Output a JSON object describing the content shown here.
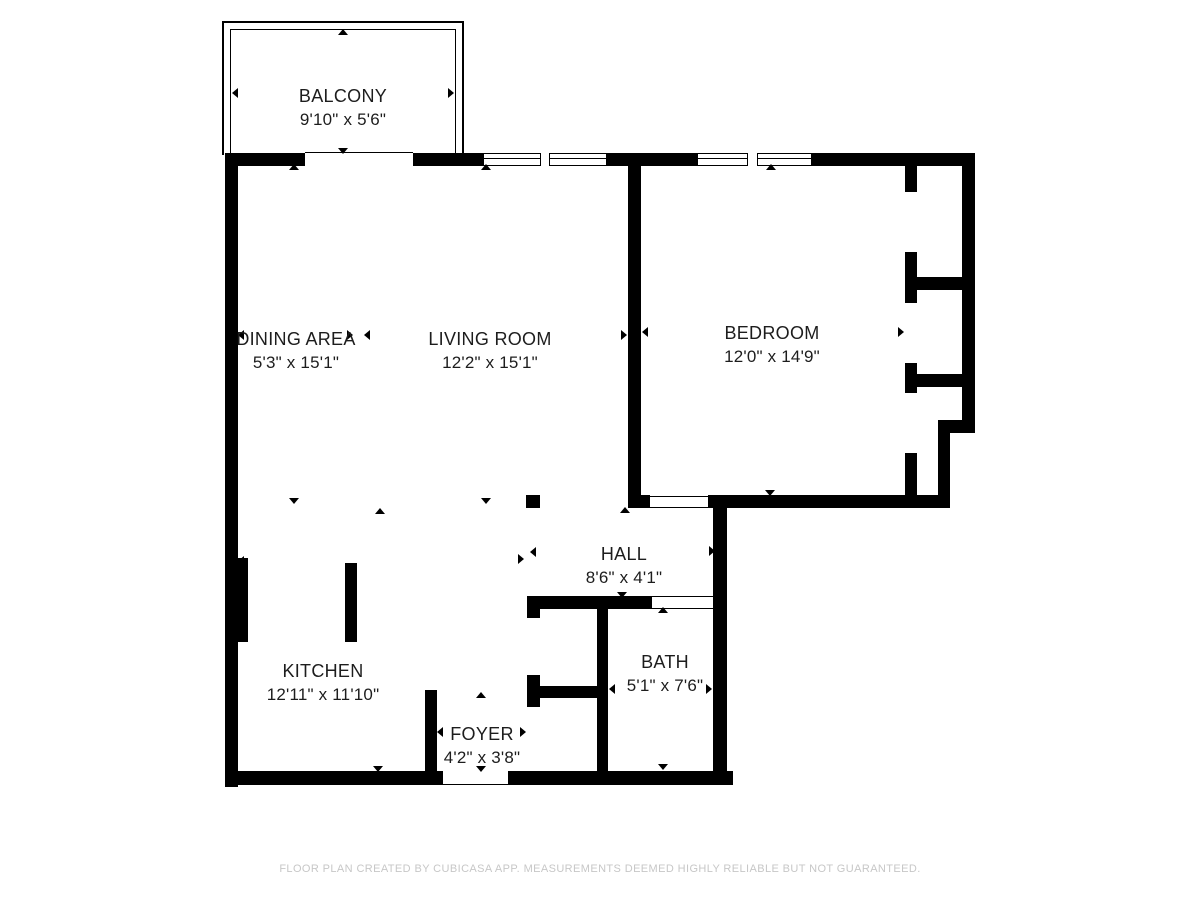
{
  "rooms": {
    "balcony": {
      "name": "BALCONY",
      "dimensions": "9'10\" x 5'6\""
    },
    "dining": {
      "name": "DINING AREA",
      "dimensions": "5'3\" x 15'1\""
    },
    "living": {
      "name": "LIVING ROOM",
      "dimensions": "12'2\" x 15'1\""
    },
    "bedroom": {
      "name": "BEDROOM",
      "dimensions": "12'0\" x 14'9\""
    },
    "hall": {
      "name": "HALL",
      "dimensions": "8'6\" x 4'1\""
    },
    "bath": {
      "name": "BATH",
      "dimensions": "5'1\" x 7'6\""
    },
    "kitchen": {
      "name": "KITCHEN",
      "dimensions": "12'11\" x 11'10\""
    },
    "foyer": {
      "name": "FOYER",
      "dimensions": "4'2\" x 3'8\""
    }
  },
  "footer": {
    "disclaimer": "FLOOR PLAN CREATED BY CUBICASA APP. MEASUREMENTS DEEMED HIGHLY RELIABLE BUT NOT GUARANTEED."
  },
  "colors": {
    "wall": "#000000",
    "label_text": "#1d1d1d",
    "footer_text": "#c7c7c7",
    "background": "#ffffff"
  }
}
